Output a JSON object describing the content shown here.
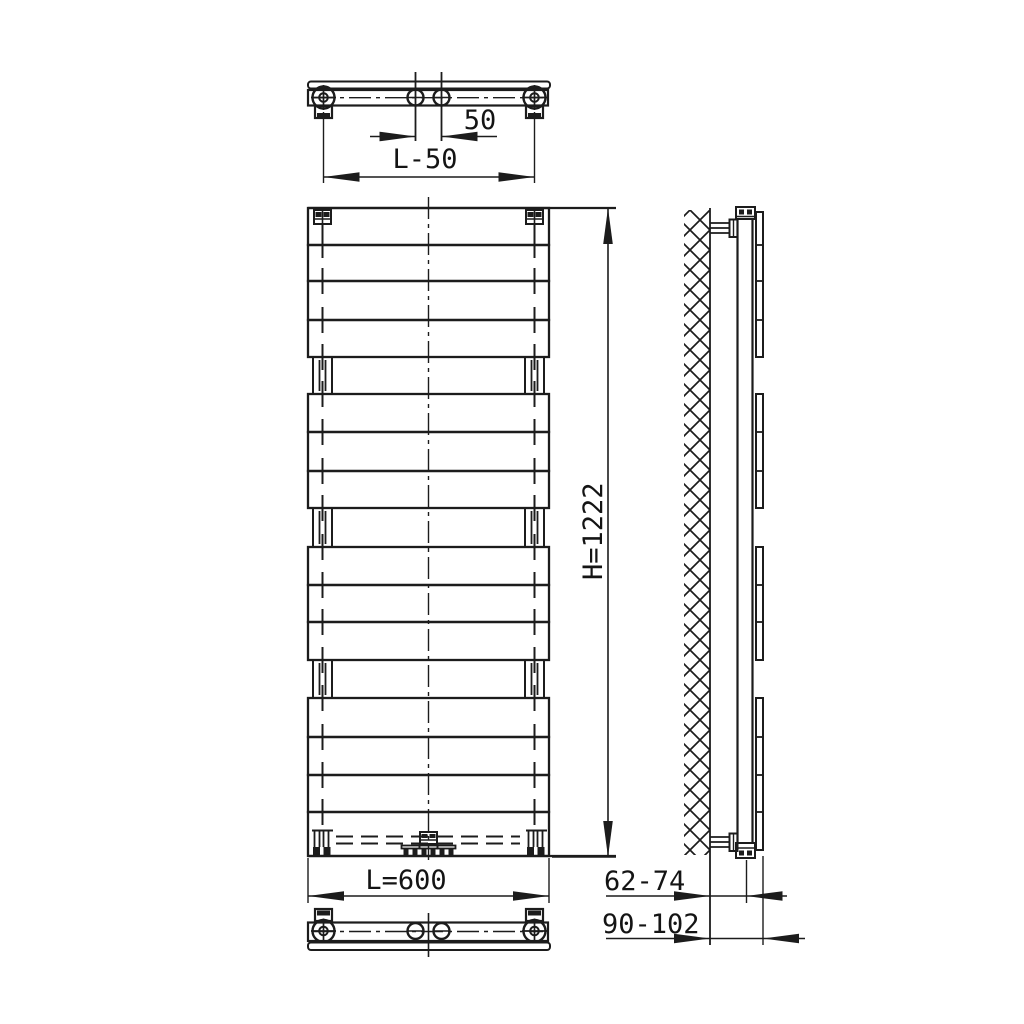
{
  "dimensions": {
    "pipe_spacing": "50",
    "mounting_width": "L-50",
    "height": "H=1222",
    "width": "L=600",
    "wall_to_pipe_axis": "62-74",
    "wall_to_front": "90-102"
  }
}
